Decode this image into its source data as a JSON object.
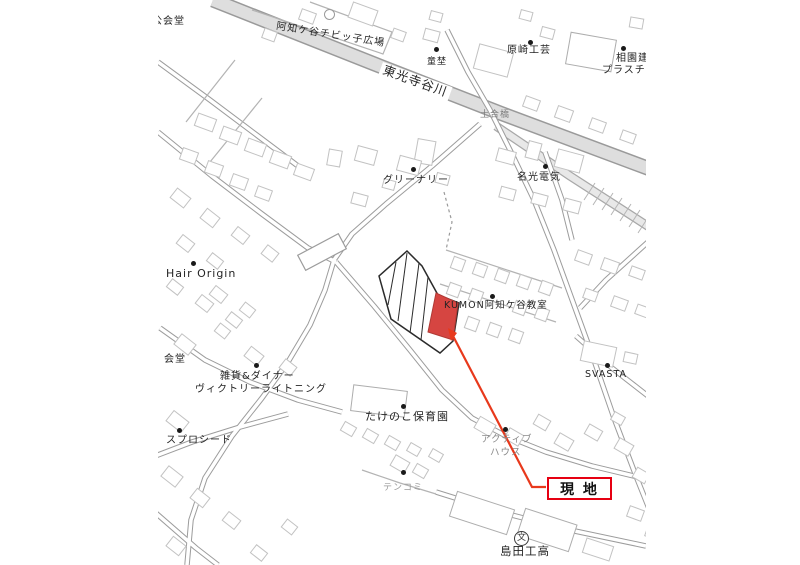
{
  "site_label": {
    "text": "現 地"
  },
  "symbols": {
    "school": "文"
  },
  "colors": {
    "site_fill": "#d64541",
    "site_stroke": "#b03a35",
    "leader_line": "#e8391c",
    "genchi_border": "#e60012",
    "river_fill": "#dedede",
    "road_casing": "#9c9c9c",
    "building_outline": "#c2c2c2",
    "label_text": "#242424",
    "muted_text": "#8a8a8a"
  },
  "map_labels": [
    {
      "text": "公会堂",
      "x": 152,
      "y": 17,
      "size": 10
    },
    {
      "text": "阿知ケ谷チビッ子広場",
      "x": 277,
      "y": 22,
      "size": 10,
      "rot": 9
    },
    {
      "text": "東光寺谷川",
      "x": 383,
      "y": 62,
      "size": 12.5,
      "rot": 20,
      "bg": true
    },
    {
      "text": "童埜",
      "x": 427,
      "y": 58,
      "size": 9
    },
    {
      "text": "原崎工芸",
      "x": 507,
      "y": 46,
      "size": 10
    },
    {
      "text": "相園建",
      "x": 616,
      "y": 54,
      "size": 10
    },
    {
      "text": "プラスチ",
      "x": 602,
      "y": 66,
      "size": 10
    },
    {
      "text": "土合橋",
      "x": 480,
      "y": 111,
      "size": 9,
      "color": "#7d7d7d"
    },
    {
      "text": "グリーナリー",
      "x": 383,
      "y": 176,
      "size": 10
    },
    {
      "text": "名光電気",
      "x": 517,
      "y": 173,
      "size": 10
    },
    {
      "text": "Hair Origin",
      "x": 166,
      "y": 268,
      "size": 11
    },
    {
      "text": "KUMON阿知ケ谷教室",
      "x": 444,
      "y": 301,
      "size": 9.5
    },
    {
      "text": "会堂",
      "x": 164,
      "y": 355,
      "size": 10
    },
    {
      "text": "雑貨&ダイナー",
      "x": 220,
      "y": 372,
      "size": 10
    },
    {
      "text": "ヴィクトリーライトニング",
      "x": 195,
      "y": 385,
      "size": 10
    },
    {
      "text": "SVASTA",
      "x": 585,
      "y": 370,
      "size": 9.5
    },
    {
      "text": "たけのこ保育園",
      "x": 365,
      "y": 411,
      "size": 11
    },
    {
      "text": "アクティブ",
      "x": 481,
      "y": 435,
      "size": 9.5,
      "color": "#8a8a8a"
    },
    {
      "text": "ハウス",
      "x": 490,
      "y": 448,
      "size": 9.5,
      "color": "#8a8a8a"
    },
    {
      "text": "スプロシード",
      "x": 166,
      "y": 436,
      "size": 10
    },
    {
      "text": "テンコミ",
      "x": 383,
      "y": 484,
      "size": 9,
      "color": "#9a9a9a"
    },
    {
      "text": "島田工高",
      "x": 500,
      "y": 546,
      "size": 11.5
    }
  ],
  "poi_dots": [
    {
      "x": 436,
      "y": 49
    },
    {
      "x": 530,
      "y": 42
    },
    {
      "x": 623,
      "y": 48
    },
    {
      "x": 413,
      "y": 169
    },
    {
      "x": 545,
      "y": 166
    },
    {
      "x": 193,
      "y": 263
    },
    {
      "x": 492,
      "y": 296
    },
    {
      "x": 256,
      "y": 365
    },
    {
      "x": 607,
      "y": 365
    },
    {
      "x": 403,
      "y": 406
    },
    {
      "x": 179,
      "y": 430
    },
    {
      "x": 505,
      "y": 429
    },
    {
      "x": 403,
      "y": 472
    }
  ]
}
